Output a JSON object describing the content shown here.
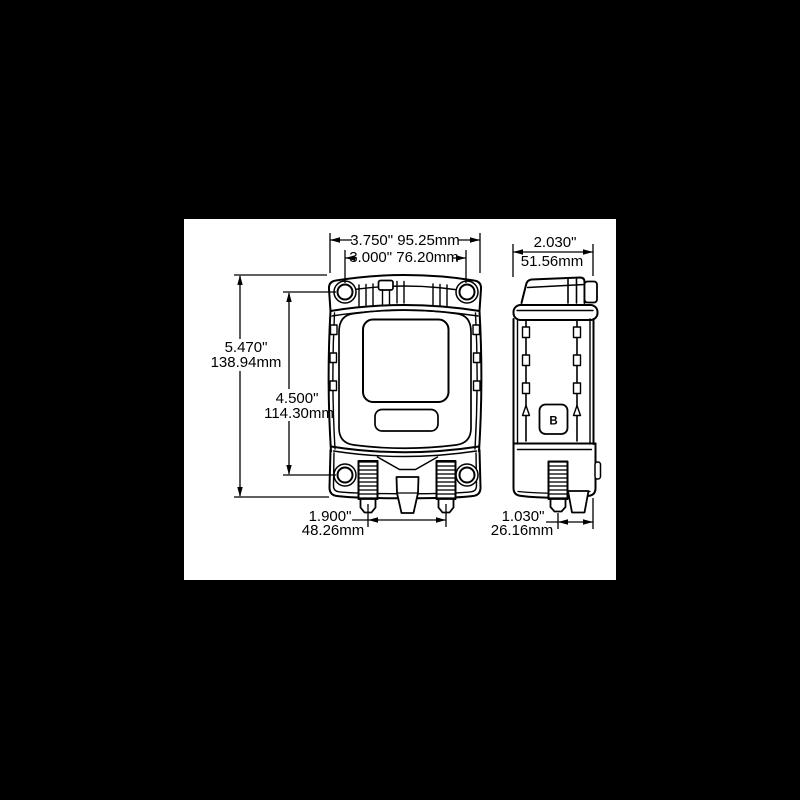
{
  "page": {
    "background_color": "#000000"
  },
  "sheet": {
    "background_color": "#ffffff",
    "line_color": "#000000"
  },
  "side_view": {
    "marking": "B"
  },
  "dimensions": {
    "overall_width": {
      "text": "3.750\" 95.25mm"
    },
    "mount_hole_spacing": {
      "text": "3.000\" 76.20mm"
    },
    "side_width": {
      "in": "2.030\"",
      "mm": "51.56mm"
    },
    "overall_height": {
      "in": "5.470\"",
      "mm": "138.94mm"
    },
    "mount_hole_vspacing": {
      "in": "4.500\"",
      "mm": "114.30mm"
    },
    "stud_spacing": {
      "in": "1.900\"",
      "mm": "48.26mm"
    },
    "side_stud_offset": {
      "in": "1.030\"",
      "mm": "26.16mm"
    }
  }
}
